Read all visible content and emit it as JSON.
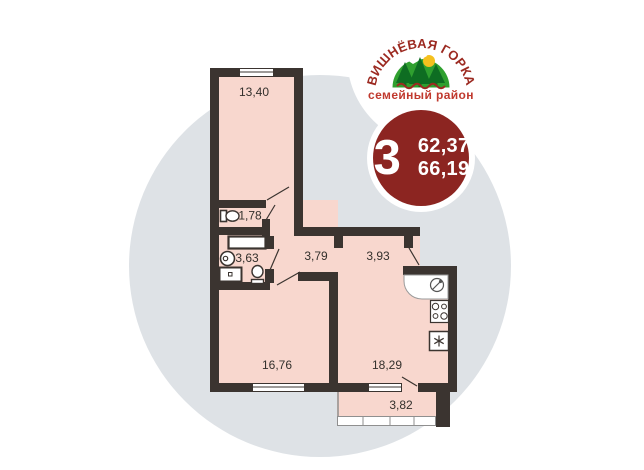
{
  "brand": {
    "name": "ВИШНЁВАЯ ГОРКА",
    "tagline": "семейный район"
  },
  "badge": {
    "rooms": "3",
    "living_area": "62,37",
    "total_area": "66,19"
  },
  "plan": {
    "rooms": [
      {
        "id": "bedroom",
        "area": "13,40"
      },
      {
        "id": "wc",
        "area": "1,78"
      },
      {
        "id": "bathroom",
        "area": "3,63"
      },
      {
        "id": "hallway-1",
        "area": "3,79"
      },
      {
        "id": "hallway-2",
        "area": "3,93"
      },
      {
        "id": "living-room",
        "area": "16,76"
      },
      {
        "id": "kitchen-living-room",
        "area": "18,29"
      },
      {
        "id": "balcony",
        "area": "3,82"
      }
    ]
  },
  "colors": {
    "wall": "#3b3430",
    "room_fill": "#f8d7ce",
    "background_circle": "#dee2e6",
    "badge_red": "#8c2521",
    "brand_red": "#9c2a21",
    "tagline_red": "#c0392e",
    "brand_green": "#2fa02f",
    "tree_green": "#0e6d22",
    "sun_yellow": "#f4c01e"
  }
}
